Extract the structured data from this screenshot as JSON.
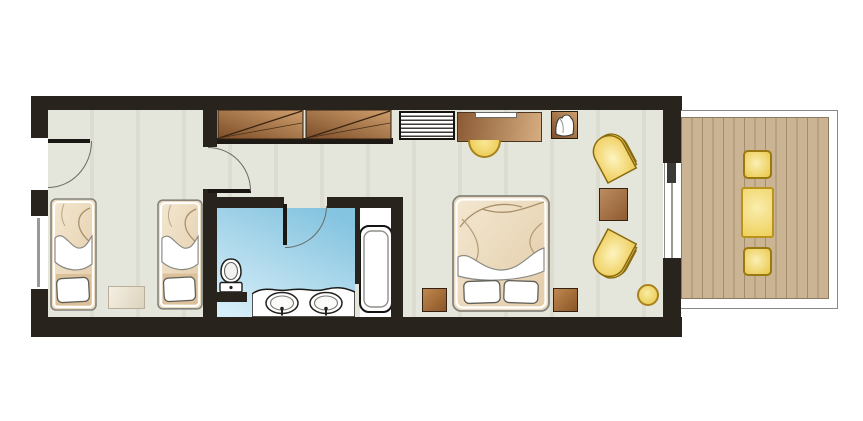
{
  "title": "Hotel room floor plan",
  "colors": {
    "wall": "#29231e",
    "floor": "#e5e6db",
    "floorBand": "#dcddd0",
    "bathDark": "#85c4e0",
    "bathLight": "#d6eef8",
    "woodDark": "#7c4d28",
    "woodLight": "#cf9f6d",
    "deck": "#cbb494",
    "deckLine": "#a28e6e",
    "bedTan": "#ecdbc1",
    "bedTanDark": "#dcc09a",
    "gold": "#e9c446",
    "goldLight": "#f9eda5",
    "goldBorder": "#a8821c",
    "white": "#ffffff"
  },
  "rooms": [
    {
      "name": "twin-bedroom",
      "furniture": [
        "twin-bed",
        "twin-bed",
        "rug"
      ]
    },
    {
      "name": "corridor",
      "furniture": [
        "wardrobe-2-panels",
        "entrance-door",
        "bedroom-door"
      ]
    },
    {
      "name": "bathroom",
      "furniture": [
        "toilet",
        "double-vanity-two-sinks",
        "bathtub",
        "bathroom-door"
      ]
    },
    {
      "name": "master-bedroom",
      "furniture": [
        "minibar",
        "desk",
        "desk-stool",
        "luggage-rack",
        "double-bed",
        "nightstand",
        "nightstand",
        "armchair",
        "armchair",
        "coffee-table",
        "round-stool",
        "sliding-door"
      ]
    },
    {
      "name": "balcony",
      "furniture": [
        "wood-deck",
        "patio-chair",
        "patio-table",
        "patio-chair"
      ]
    }
  ]
}
